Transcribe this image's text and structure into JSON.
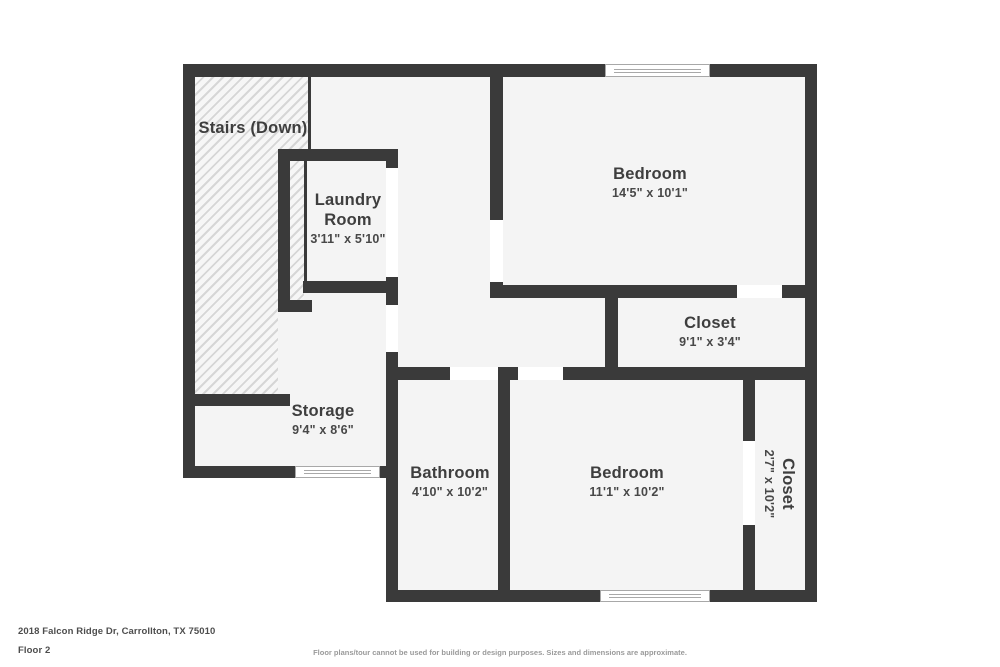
{
  "rooms": {
    "stairs": {
      "name": "Stairs (Down)"
    },
    "laundry": {
      "name": "Laundry Room",
      "dims": "3'11\" x 5'10\""
    },
    "bedroom_top": {
      "name": "Bedroom",
      "dims": "14'5\" x 10'1\""
    },
    "closet_top": {
      "name": "Closet",
      "dims": "9'1\" x 3'4\""
    },
    "storage": {
      "name": "Storage",
      "dims": "9'4\" x 8'6\""
    },
    "bathroom": {
      "name": "Bathroom",
      "dims": "4'10\" x 10'2\""
    },
    "bedroom_bottom": {
      "name": "Bedroom",
      "dims": "11'1\" x 10'2\""
    },
    "closet_right": {
      "name": "Closet",
      "dims": "2'7\" x 10'2\""
    }
  },
  "footer": {
    "address": "2018 Falcon Ridge Dr, Carrollton, TX 75010",
    "floor": "Floor 2",
    "disclaimer": "Floor plans/tour cannot be used for building or design purposes. Sizes and dimensions are approximate."
  },
  "colors": {
    "wall": "#3a3a3a",
    "floor": "#f4f4f4",
    "hatch_stripe": "#d6d6d6",
    "window_line": "#a8a8a8",
    "text": "#3e3e3e"
  }
}
